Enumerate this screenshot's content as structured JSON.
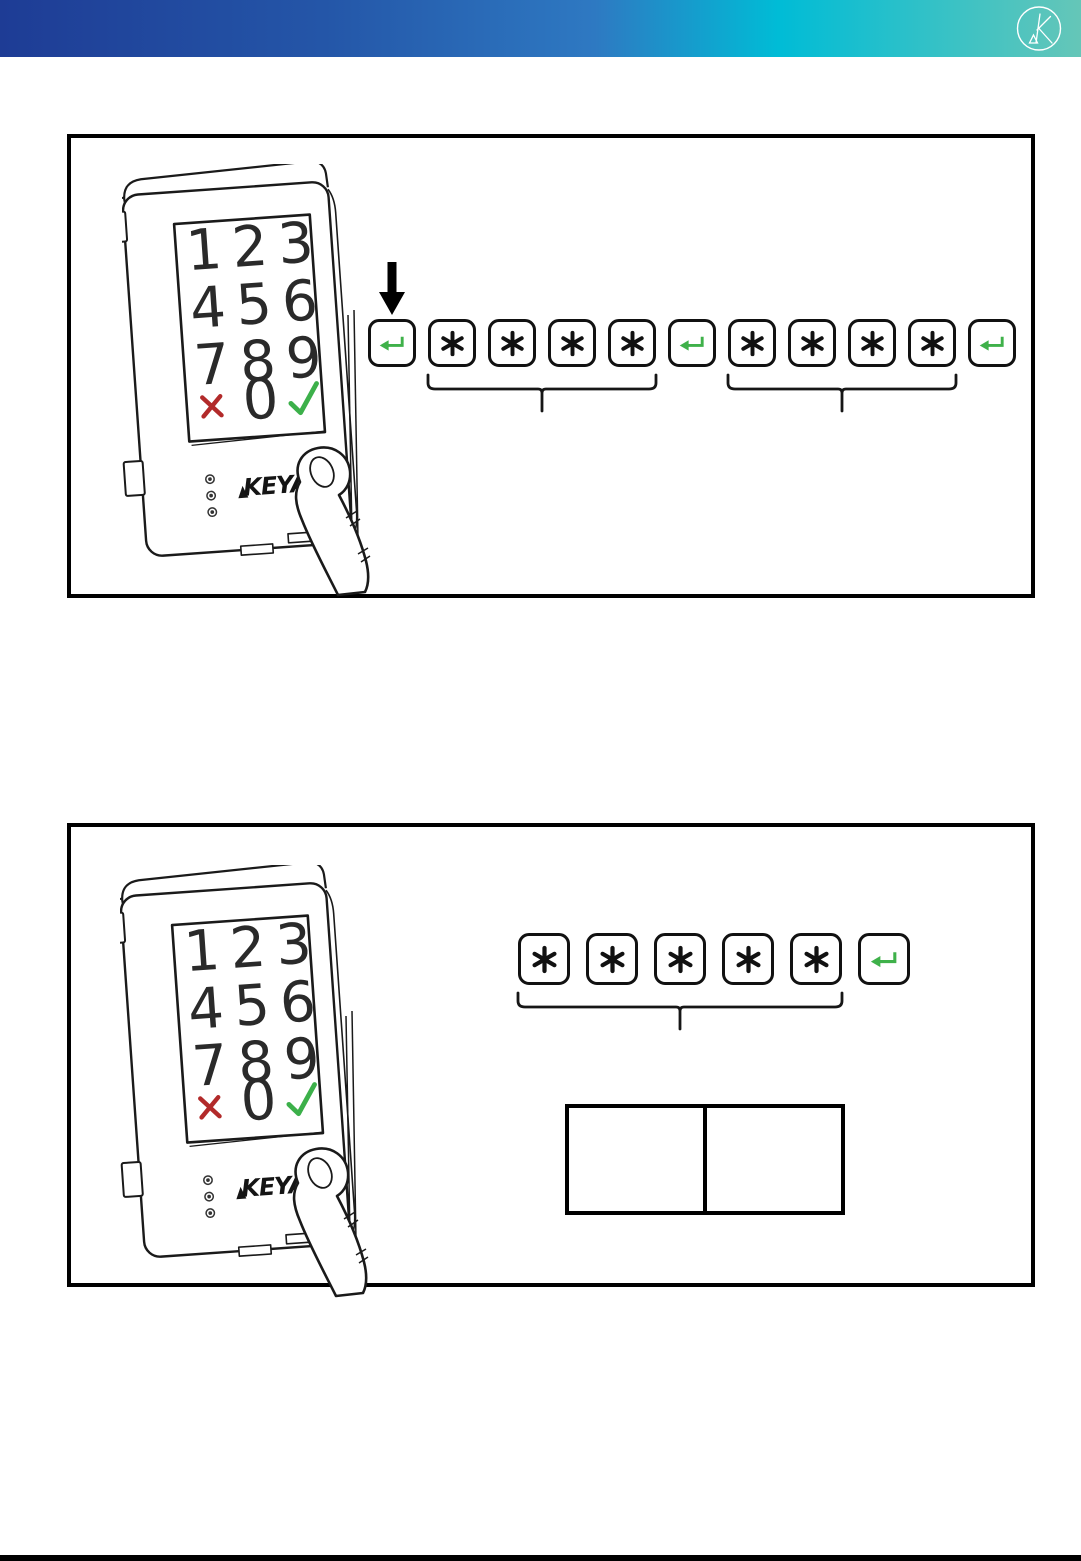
{
  "header": {
    "logo_letter": "K",
    "gradient_colors": [
      "#1e3c95",
      "#2456a8",
      "#2e79c2",
      "#00bcd6",
      "#65c6b8"
    ]
  },
  "keypad_device": {
    "brand": "KEYA",
    "digit_rows": [
      [
        "1",
        "2",
        "3"
      ],
      [
        "4",
        "5",
        "6"
      ],
      [
        "7",
        "8",
        "9"
      ]
    ],
    "zero": "0",
    "cancel_symbol": "✕",
    "confirm_symbol": "✓",
    "cancel_color": "#b22a2a",
    "confirm_color": "#3cb04a",
    "led_count": 3
  },
  "key_icons": {
    "star_symbol": "*",
    "enter_symbol": "↵",
    "enter_color": "#3fb14a",
    "key_border_color": "#111111"
  },
  "figure1": {
    "sequence": [
      "enter",
      "star",
      "star",
      "star",
      "star",
      "enter",
      "star",
      "star",
      "star",
      "star",
      "enter"
    ],
    "grouped_key_ranges": [
      [
        1,
        4
      ],
      [
        6,
        9
      ]
    ],
    "arrow_above_key_index": 0
  },
  "figure2": {
    "sequence": [
      "star",
      "star",
      "star",
      "star",
      "star",
      "enter"
    ],
    "grouped_key_ranges": [
      [
        0,
        4
      ]
    ],
    "table_cells": [
      "",
      ""
    ]
  },
  "footer": {
    "bar_color": "#000000"
  }
}
